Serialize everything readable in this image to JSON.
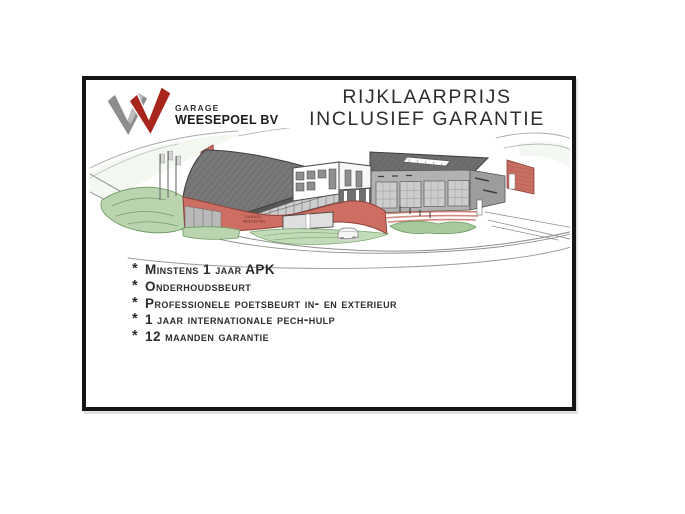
{
  "page": {
    "background": "#ffffff",
    "frame_border_color": "#151515"
  },
  "logo": {
    "garage_label": "GARAGE",
    "company_name": "WEESEPOEL BV",
    "mark_colors": {
      "gray": "#8d8d8d",
      "gray_light": "#bcbcbc",
      "red": "#a8251c"
    }
  },
  "title": {
    "line1": "RIJKLAARPRIJS",
    "line2": "INCLUSIEF GARANTIE"
  },
  "illustration": {
    "building_sign_line1": "GARAGE",
    "building_sign_line2": "WEESEPOEL",
    "palette": {
      "wall_red": "#ce6e62",
      "roof_gray": "#787878",
      "workshop_gray": "#b2b2b2",
      "landscape_green": "#b9d4ae"
    }
  },
  "features": {
    "bullet": "*",
    "items": [
      "Minstens 1 jaar APK",
      "Onderhoudsbeurt",
      "Professionele poetsbeurt in- en exterieur",
      "1 jaar internationale pech-hulp",
      "12 maanden garantie"
    ]
  }
}
